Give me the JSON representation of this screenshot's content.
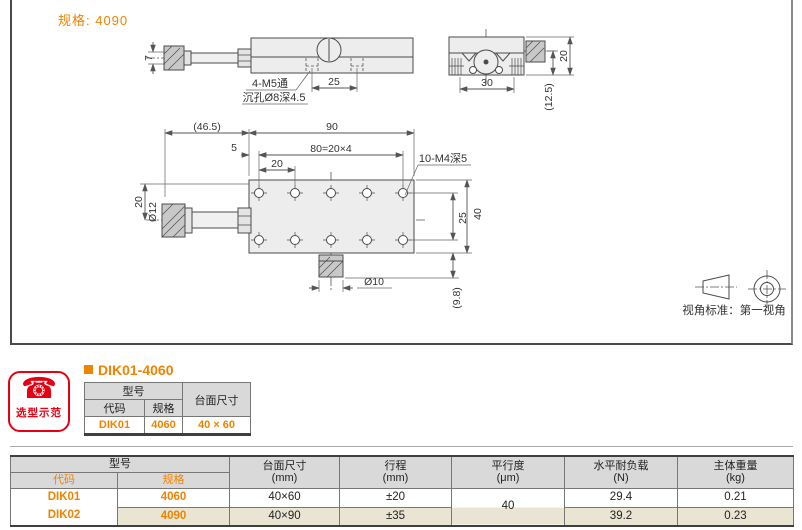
{
  "colors": {
    "accent": "#f08300",
    "badge_red": "#e60012",
    "header_gray": "#d9d9d9",
    "row_beige": "#e9e5d2"
  },
  "drawing": {
    "spec_label": "规格: 4090",
    "front_view": {
      "dim_height": "7",
      "thread_callout": "4-M5通",
      "counterbore_callout": "沉孔Ø8深4.5",
      "dim_pitch": "25"
    },
    "side_view": {
      "dim_width": "30",
      "dim_height": "20",
      "dim_ref": "(12.5)"
    },
    "top_view": {
      "dim_ref_length": "(46.5)",
      "dim_length": "90",
      "dim_edge": "5",
      "dim_hole_span": "80=20×4",
      "dim_hole_pitch": "20",
      "tap_callout": "10-M4深5",
      "dim_shaft_dia": "Ø12",
      "dim_half_width": "20",
      "dim_row_pitch": "25",
      "dim_width": "40",
      "dim_knob_dia": "Ø10",
      "dim_knob_ref": "(9.8)"
    },
    "view_note": "视角标准：第一视角"
  },
  "badge": {
    "icon": "☎",
    "label": "选型示范"
  },
  "example": {
    "title": "DIK01-4060",
    "headers": {
      "model": "型号",
      "code": "代码",
      "spec": "规格",
      "size": "台面尺寸"
    },
    "row": {
      "code": "DIK01",
      "spec": "4060",
      "size": "40 × 60"
    }
  },
  "spec_table": {
    "headers": {
      "model": "型号",
      "code": "代码",
      "spec": "规格",
      "size": "台面尺寸",
      "size_unit": "(mm)",
      "travel": "行程",
      "travel_unit": "(mm)",
      "parallelism": "平行度",
      "parallelism_unit": "(μm)",
      "load": "水平耐负载",
      "load_unit": "(N)",
      "weight": "主体重量",
      "weight_unit": "(kg)"
    },
    "parallelism_shared": "40",
    "rows": [
      {
        "code": "DIK01",
        "spec": "4060",
        "size": "40×60",
        "travel": "±20",
        "load": "29.4",
        "weight": "0.21"
      },
      {
        "code": "DIK02",
        "spec": "4090",
        "size": "40×90",
        "travel": "±35",
        "load": "39.2",
        "weight": "0.23"
      }
    ]
  }
}
